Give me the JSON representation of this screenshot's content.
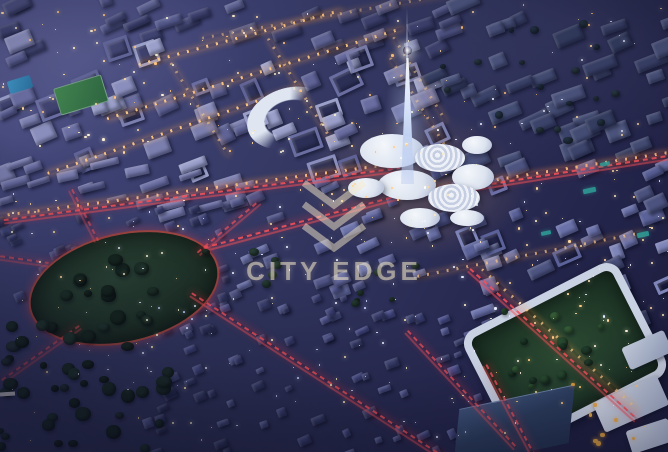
{
  "image_type": "aerial-night-render",
  "description": "Aerial night rendering of a master-planned city district with an illuminated central spire, white organic plaza buildings, red-lit boulevards, an oval park roundabout and villa neighborhoods",
  "watermark": {
    "text": "CITY EDGE",
    "logo": "city-edge-chevron-logo",
    "color": "rgba(243,231,202,0.55)"
  },
  "palette": {
    "dusk_blue": "#343862",
    "villa_blue": "#4a4f8b",
    "midrise_lavender": "#8a8ebc",
    "window_warm": "#ffd9a0",
    "road_red": "#f05058",
    "landmark_white": "#dfe6f2",
    "park_green": "#22372b",
    "pitch_green": "#3c7a4b",
    "pool_blue": "#2f7fae",
    "teal_accent": "#2fa39a"
  },
  "scene": {
    "seed": 7,
    "buildings": [
      {
        "name": "skyline-strip",
        "x": -8,
        "y": -8,
        "w": 450,
        "h": 52,
        "count": 30,
        "minW": 12,
        "maxW": 30,
        "minH": 7,
        "maxH": 14,
        "rot": -22,
        "colors": [
          "#4a4e7c",
          "#555a8c",
          "#3f4370",
          "#606595"
        ]
      },
      {
        "name": "uptown-midrise",
        "x": -8,
        "y": 28,
        "w": 440,
        "h": 140,
        "count": 66,
        "minW": 11,
        "maxW": 28,
        "minH": 8,
        "maxH": 18,
        "rot": -22,
        "hollow": 0.28,
        "colors": [
          "#7b7fae",
          "#8a8ebc",
          "#696da0",
          "#9aa0ca",
          "#5f6396"
        ]
      },
      {
        "name": "west-townhomes",
        "x": -8,
        "y": 150,
        "w": 250,
        "h": 60,
        "count": 26,
        "minW": 14,
        "maxW": 30,
        "minH": 6,
        "maxH": 10,
        "rot": -16,
        "colors": [
          "#6c70a4",
          "#7a7eb0",
          "#5d6194"
        ]
      },
      {
        "name": "far-east-blocks",
        "x": 420,
        "y": -8,
        "w": 256,
        "h": 165,
        "count": 40,
        "minW": 14,
        "maxW": 34,
        "minH": 9,
        "maxH": 18,
        "rot": -22,
        "colors": [
          "#3e466e",
          "#475078",
          "#374064",
          "#4f5882"
        ]
      },
      {
        "name": "east-midrise",
        "x": 428,
        "y": 152,
        "w": 245,
        "h": 168,
        "count": 42,
        "minW": 12,
        "maxW": 26,
        "minH": 8,
        "maxH": 16,
        "rot": -22,
        "hollow": 0.2,
        "colors": [
          "#5b6299",
          "#6b72a9",
          "#4d5480",
          "#7e85b8"
        ]
      },
      {
        "name": "center-blocks",
        "x": 230,
        "y": 178,
        "w": 205,
        "h": 118,
        "count": 26,
        "minW": 10,
        "maxW": 22,
        "minH": 7,
        "maxH": 14,
        "rot": -22,
        "colors": [
          "#5d639b",
          "#6d74ab",
          "#515687"
        ]
      },
      {
        "name": "south-villas",
        "x": 140,
        "y": 293,
        "w": 345,
        "h": 160,
        "count": 82,
        "minW": 7,
        "maxW": 14,
        "minH": 5,
        "maxH": 10,
        "rot": -22,
        "colors": [
          "#4a4f8b",
          "#41467b",
          "#565c97",
          "#3c4170"
        ]
      },
      {
        "name": "west-villas",
        "x": -8,
        "y": 205,
        "w": 235,
        "h": 125,
        "count": 46,
        "minW": 7,
        "maxW": 14,
        "minH": 5,
        "maxH": 10,
        "rot": -22,
        "colors": [
          "#3f4478",
          "#474d85",
          "#363a66"
        ]
      }
    ],
    "trees": [
      {
        "name": "southwest-grove",
        "x": -5,
        "y": 312,
        "w": 170,
        "h": 138,
        "count": 42,
        "min": 7,
        "max": 16,
        "colors": [
          "#1c2e27",
          "#223831",
          "#182720",
          "#26363a"
        ]
      },
      {
        "name": "oval-park-trees",
        "x": 58,
        "y": 252,
        "w": 130,
        "h": 72,
        "count": 14,
        "min": 8,
        "max": 18,
        "colors": [
          "#16261f",
          "#1d3128"
        ]
      },
      {
        "name": "courtyard-trees",
        "x": 500,
        "y": 308,
        "w": 122,
        "h": 86,
        "count": 16,
        "min": 6,
        "max": 12,
        "colors": [
          "#1f3a2a",
          "#27482f",
          "#355c38"
        ]
      },
      {
        "name": "boulevard-trees",
        "x": 200,
        "y": 248,
        "w": 250,
        "h": 55,
        "count": 12,
        "min": 5,
        "max": 10,
        "colors": [
          "#1e3029",
          "#243a30"
        ]
      },
      {
        "name": "far-east-trees",
        "x": 440,
        "y": 15,
        "w": 215,
        "h": 125,
        "count": 18,
        "min": 5,
        "max": 10,
        "colors": [
          "#2a3a44",
          "#223240"
        ]
      }
    ],
    "streets": [
      {
        "name": "avenue-a-warm",
        "type": "warm",
        "cx": 200,
        "cy": 188,
        "len": 408,
        "angle": -7.5
      },
      {
        "name": "avenue-a-red",
        "type": "red",
        "cx": 202,
        "cy": 193,
        "len": 400,
        "angle": -7.5
      },
      {
        "name": "uptown-street-1",
        "type": "warm",
        "cx": 255,
        "cy": 72,
        "len": 310,
        "angle": -17
      },
      {
        "name": "uptown-street-2",
        "type": "warm",
        "cx": 175,
        "cy": 128,
        "len": 270,
        "angle": -19
      },
      {
        "name": "uptown-street-3",
        "type": "warm",
        "cx": 240,
        "cy": 36,
        "len": 210,
        "angle": -15
      },
      {
        "name": "uptown-cross-1",
        "type": "warm",
        "cx": 300,
        "cy": 88,
        "len": 120,
        "angle": 58,
        "o": 0.7
      },
      {
        "name": "uptown-cross-2",
        "type": "warm",
        "cx": 200,
        "cy": 108,
        "len": 110,
        "angle": 58,
        "o": 0.6
      },
      {
        "name": "uptown-cross-3",
        "type": "warm",
        "cx": 420,
        "cy": 78,
        "len": 100,
        "angle": 58,
        "o": 0.6
      },
      {
        "name": "right-avenue-warm",
        "type": "warm",
        "cx": 548,
        "cy": 170,
        "len": 245,
        "angle": -9
      },
      {
        "name": "right-avenue-red",
        "type": "red",
        "cx": 548,
        "cy": 174,
        "len": 240,
        "angle": -9
      },
      {
        "name": "right-avenue-2",
        "type": "warm",
        "cx": 530,
        "cy": 253,
        "len": 230,
        "angle": -11,
        "o": 0.75
      },
      {
        "name": "plaza-south-red",
        "type": "red",
        "cx": 300,
        "cy": 221,
        "len": 200,
        "angle": -15
      },
      {
        "name": "villas-main-red",
        "type": "red",
        "cx": 330,
        "cy": 382,
        "len": 330,
        "angle": 33
      },
      {
        "name": "oval-spoke-ne",
        "type": "red",
        "cx": 228,
        "cy": 226,
        "len": 80,
        "angle": -40,
        "o": 0.8
      },
      {
        "name": "oval-spoke-n",
        "type": "red",
        "cx": 85,
        "cy": 214,
        "len": 58,
        "angle": 63,
        "o": 0.7
      },
      {
        "name": "oval-spoke-w",
        "type": "red",
        "cx": 20,
        "cy": 258,
        "len": 58,
        "angle": 8,
        "o": 0.7
      },
      {
        "name": "oval-spoke-sw",
        "type": "red",
        "cx": 40,
        "cy": 352,
        "len": 95,
        "angle": -35,
        "o": 0.7
      },
      {
        "name": "br-boulevard-red",
        "type": "red",
        "cx": 553,
        "cy": 343,
        "len": 225,
        "angle": 42
      },
      {
        "name": "br-boulevard-warm",
        "type": "warm",
        "cx": 560,
        "cy": 338,
        "len": 210,
        "angle": 42,
        "o": 0.8
      },
      {
        "name": "br-street-red",
        "type": "red",
        "cx": 512,
        "cy": 412,
        "len": 110,
        "angle": 62,
        "o": 0.9
      },
      {
        "name": "villas-east-red",
        "type": "red",
        "cx": 462,
        "cy": 388,
        "len": 160,
        "angle": 47,
        "o": 0.85
      },
      {
        "name": "top-strip-street",
        "type": "warm",
        "cx": 330,
        "cy": 14,
        "len": 260,
        "angle": -10,
        "o": 0.55
      },
      {
        "name": "tower-axis-street",
        "type": "warm",
        "cx": 430,
        "cy": 120,
        "len": 150,
        "angle": 58,
        "o": 0.6
      }
    ],
    "lights": [
      {
        "name": "uptown-lights",
        "x": 0,
        "y": 10,
        "w": 430,
        "h": 150,
        "count": 95,
        "min": 1,
        "max": 2.6,
        "colors": [
          "#ffd9a0",
          "#ffc27a",
          "#fff2d8",
          "#f5e6c8"
        ]
      },
      {
        "name": "far-east-lights",
        "x": 430,
        "y": 0,
        "w": 238,
        "h": 150,
        "count": 38,
        "min": 1,
        "max": 2.2,
        "colors": [
          "#ffd9a0",
          "#e8ecff",
          "#ffc27a"
        ]
      },
      {
        "name": "east-lights",
        "x": 425,
        "y": 150,
        "w": 243,
        "h": 175,
        "count": 60,
        "min": 1,
        "max": 2.4,
        "colors": [
          "#ffd9a0",
          "#ffe9c0",
          "#e8ecff"
        ]
      },
      {
        "name": "south-villa-lights",
        "x": 145,
        "y": 296,
        "w": 330,
        "h": 150,
        "count": 65,
        "min": 1,
        "max": 2,
        "colors": [
          "#eef0ff",
          "#fff3cf",
          "#ccd6ff",
          "#ffe9b8"
        ]
      },
      {
        "name": "west-villa-lights",
        "x": 5,
        "y": 185,
        "w": 215,
        "h": 135,
        "count": 40,
        "min": 1,
        "max": 2,
        "colors": [
          "#eef0ff",
          "#fff3cf",
          "#ffd9a0"
        ]
      },
      {
        "name": "southwest-lights",
        "x": 5,
        "y": 330,
        "w": 160,
        "h": 112,
        "count": 16,
        "min": 1,
        "max": 1.8,
        "colors": [
          "#d8dcf0",
          "#ffd9a0"
        ]
      },
      {
        "name": "plaza-lights",
        "x": 330,
        "y": 118,
        "w": 150,
        "h": 125,
        "count": 26,
        "min": 1,
        "max": 2.2,
        "colors": [
          "#ffcf8a",
          "#ffe9c0",
          "#ffffff"
        ]
      },
      {
        "name": "br-complex-lights",
        "x": 480,
        "y": 298,
        "w": 175,
        "h": 135,
        "count": 34,
        "min": 1,
        "max": 2.4,
        "colors": [
          "#ffd9a0",
          "#ffc87e",
          "#fff2d8"
        ]
      },
      {
        "name": "center-lights",
        "x": 230,
        "y": 180,
        "w": 200,
        "h": 110,
        "count": 30,
        "min": 1,
        "max": 2,
        "colors": [
          "#ffd9a0",
          "#eef0ff"
        ]
      },
      {
        "name": "br-amber-trees",
        "x": 560,
        "y": 380,
        "w": 100,
        "h": 65,
        "count": 8,
        "min": 3,
        "max": 5,
        "colors": [
          "#e8a84c",
          "#d69a40"
        ]
      }
    ]
  }
}
